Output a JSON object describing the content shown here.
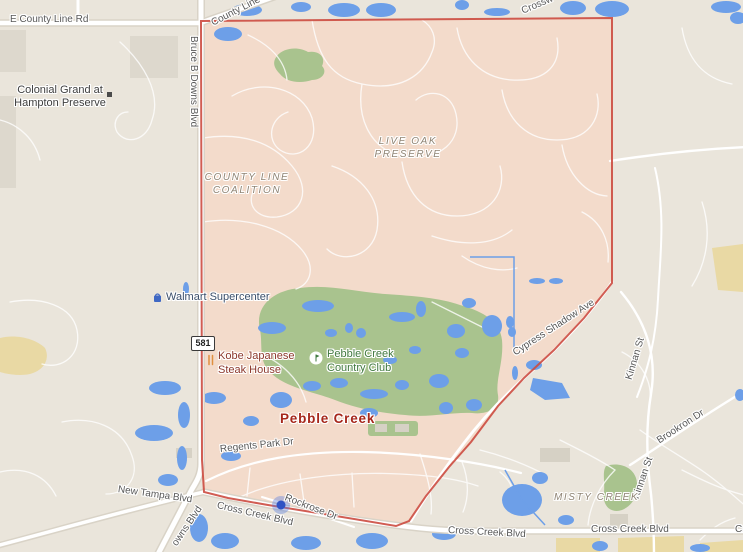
{
  "map": {
    "neighborhood": "Pebble Creek",
    "colors": {
      "base": "#eae5db",
      "region_fill": "#f3dbcb",
      "region_border": "#cc4b40",
      "road_fill": "#ffffff",
      "road_casing": "#d9d3c7",
      "water": "#6d9fe8",
      "golf_green": "#a9c38e",
      "commercial_tan": "#e9d9a4",
      "building_gray": "#dcd7cb",
      "road_label": "#585858",
      "area_label": "#8f8474",
      "poi_shopping": "#3b4f6b",
      "poi_restaurant": "#8c382c",
      "poi_golf": "#41793f",
      "neighborhood_label": "#a6271b",
      "marker_blue": "#2f52c4"
    },
    "labels": {
      "e_county_line_rd": {
        "text": "E County Line Rd"
      },
      "county_line_top": {
        "text": "County Line"
      },
      "crossw_top": {
        "text": "Crossw"
      },
      "colonial_grand": {
        "line1": "Colonial Grand at",
        "line2": "Hampton Preserve"
      },
      "bruce_b_downs": {
        "text": "Bruce B Downs Blvd"
      },
      "bruce_b_downs_fragment": {
        "text": "owns Blvd"
      },
      "live_oak_preserve": {
        "line1": "LIVE OAK",
        "line2": "PRESERVE"
      },
      "county_line_coalition": {
        "line1": "COUNTY LINE",
        "line2": "COALITION"
      },
      "walmart": {
        "text": "Walmart Supercenter"
      },
      "route_shield": {
        "text": "581"
      },
      "kobe": {
        "line1": "Kobe Japanese",
        "line2": "Steak House"
      },
      "pebble_creek_cc": {
        "line1": "Pebble Creek",
        "line2": "Country Club"
      },
      "pebble_creek_main": {
        "text": "Pebble Creek"
      },
      "cypress_shadow_ave": {
        "text": "Cypress Shadow Ave"
      },
      "kinnan_st_upper": {
        "text": "Kinnan St"
      },
      "kinnan_st_lower": {
        "text": "Kinnan St"
      },
      "brookron_dr": {
        "text": "Brookron Dr"
      },
      "misty_creek": {
        "text": "MISTY CREEK"
      },
      "regents_park_dr": {
        "text": "Regents Park Dr"
      },
      "new_tampa_blvd": {
        "text": "New Tampa Blvd"
      },
      "cross_creek_diag": {
        "text": "Cross Creek Blvd"
      },
      "rockrose_dr": {
        "text": "Rockrose Dr"
      },
      "cross_creek_mid": {
        "text": "Cross Creek Blvd"
      },
      "cross_creek_bottom": {
        "text": "Cross Creek Blvd"
      },
      "cross_creek_right_clipped": {
        "text": "Cross Creek Blvd"
      }
    }
  }
}
